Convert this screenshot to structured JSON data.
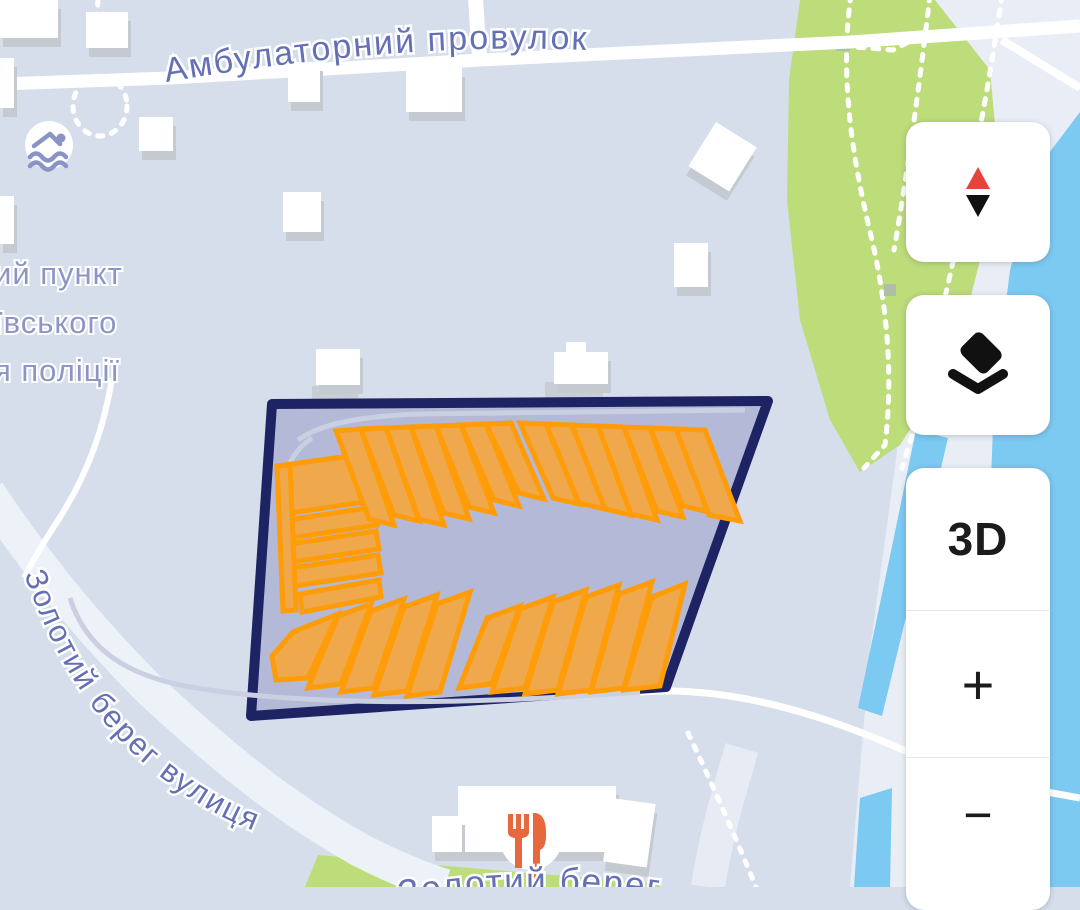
{
  "labels": {
    "street_top": "Амбулаторний провулок",
    "street_left": "Золотий берег вулиця",
    "street_bottom": "Золотий берег",
    "poi_police_line1": "ий пункт",
    "poi_police_line2": "ївського",
    "poi_police_line3": "я поліції"
  },
  "controls": {
    "compass_icon": "compass-needle-icon",
    "layers_icon": "layers-icon",
    "three_d": "3D",
    "zoom_in": "+",
    "zoom_out": "−"
  },
  "poi": {
    "swimming_icon": "swimmer-icon",
    "restaurant_icon": "fork-knife-icon"
  },
  "colors": {
    "map_bg": "#d6deec",
    "land_light": "#e9eef6",
    "water": "#7cc9f1",
    "park": "#bddc7a",
    "road": "#ffffff",
    "parcel_fill": "#b3b9d6",
    "parcel_stroke": "#1d2363",
    "building_fill": "#efa84b",
    "building_stroke": "#ff9c07",
    "street_label": "#6570b4",
    "poi_label": "#8e95c4",
    "compass_red": "#e8433a",
    "icon_black": "#111111",
    "restaurant_orange": "#e8673c",
    "swimmer_blue": "#8a93c6",
    "building_white": "#ffffff",
    "building_side": "#c5c9d0"
  }
}
